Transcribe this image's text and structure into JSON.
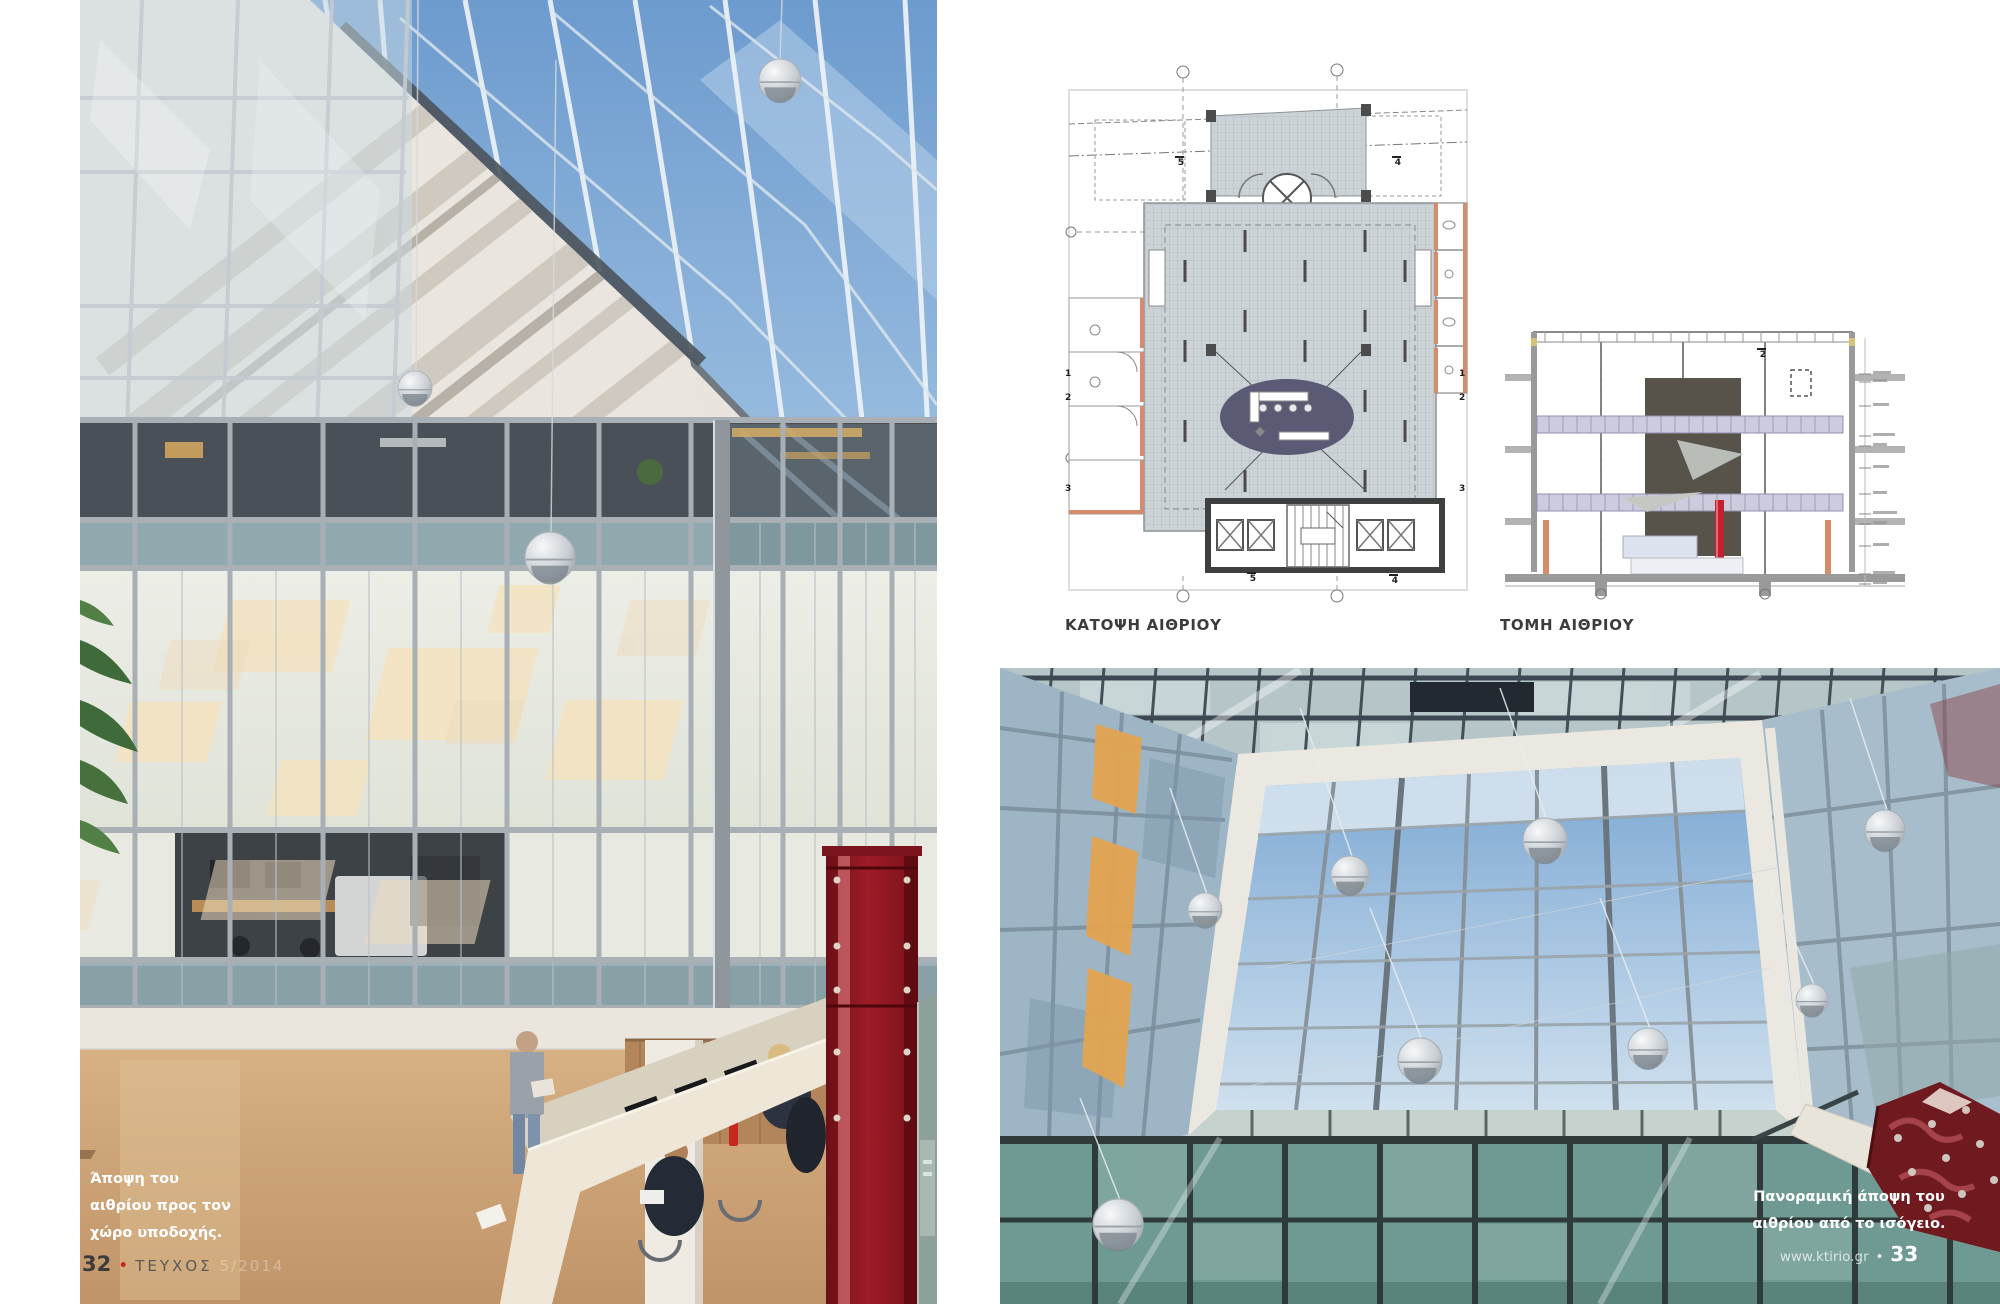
{
  "page": {
    "type": "architecture-magazine-spread",
    "background": "#ffffff"
  },
  "left_photo": {
    "alt": "atrium interior towards reception",
    "caption_line1": "Άποψη του",
    "caption_line2": "αιθρίου προς τον",
    "caption_line3": "χώρο υποδοχής."
  },
  "right_photo": {
    "alt": "atrium skylight seen from ground floor",
    "caption_line1": "Πανοραμική άποψη του",
    "caption_line2": "αιθρίου από το ισόγειο."
  },
  "plan_figure": {
    "label": "ΚΑΤΟΨΗ ΑΙΘΡΙΟΥ",
    "markers": {
      "top_left": "5",
      "top_right": "4",
      "left_1": "1",
      "left_2": "2",
      "left_3": "3",
      "right_1": "1",
      "right_2": "2",
      "right_3": "3",
      "bottom_left": "5",
      "bottom_right": "4"
    }
  },
  "section_figure": {
    "label": "ΤΟΜΗ ΑΙΘΡΙΟΥ",
    "marker": "2"
  },
  "footer_left": {
    "page_number": "32",
    "bullet": "•",
    "label": "ΤΕΥΧΟΣ",
    "issue_faint": "5/2014"
  },
  "footer_right": {
    "site": "www.ktirio.gr",
    "bullet": "•",
    "page_number": "33"
  },
  "colors": {
    "accent_red": "#c32127",
    "sky_blue": "#7fa9d6",
    "teal_glass": "#6f9a93",
    "frosted_glass": "#e7e9e0",
    "marble_floor": "#c9a377",
    "red_column": "#8c1722",
    "amber_light": "#e2a44f",
    "plan_floor": "#ccd3d7",
    "plan_rug": "#5b5a74",
    "plan_wall_accent": "#d58c6c",
    "section_wall": "#57524a",
    "section_walkway": "#ccccde"
  }
}
